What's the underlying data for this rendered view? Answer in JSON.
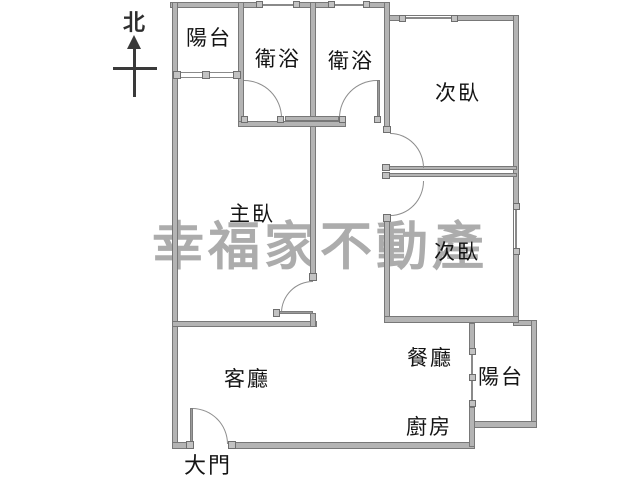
{
  "compass": {
    "label": "北"
  },
  "watermark": {
    "text": "幸福家不動產"
  },
  "rooms": [
    {
      "id": "balcony-top",
      "label": "陽台"
    },
    {
      "id": "bath-1",
      "label": "衛浴"
    },
    {
      "id": "bath-2",
      "label": "衛浴"
    },
    {
      "id": "bedroom-top",
      "label": "次臥"
    },
    {
      "id": "master-bedroom",
      "label": "主臥"
    },
    {
      "id": "bedroom-right",
      "label": "次臥"
    },
    {
      "id": "living-room",
      "label": "客廳"
    },
    {
      "id": "dining-room",
      "label": "餐廳"
    },
    {
      "id": "kitchen",
      "label": "廚房"
    },
    {
      "id": "balcony-bottom",
      "label": "陽台"
    },
    {
      "id": "entrance",
      "label": "大門"
    }
  ]
}
